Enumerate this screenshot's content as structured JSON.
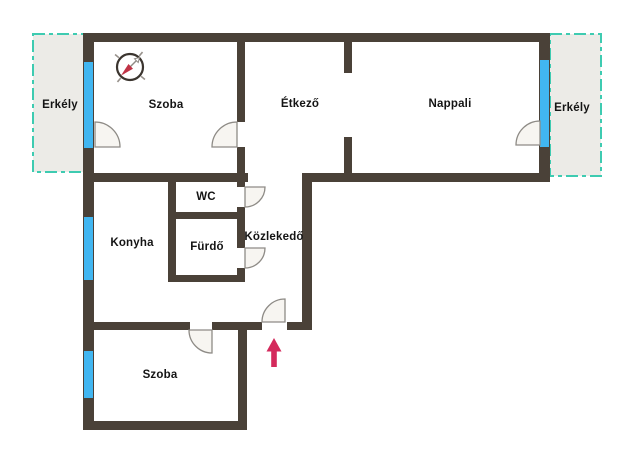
{
  "plan": {
    "type": "apartment-floor-plan",
    "language": "Hungarian",
    "rooms": [
      {
        "id": "erkely-left",
        "label": "Erkély"
      },
      {
        "id": "szoba-top",
        "label": "Szoba"
      },
      {
        "id": "etkezo",
        "label": "Étkező"
      },
      {
        "id": "nappali",
        "label": "Nappali"
      },
      {
        "id": "erkely-right",
        "label": "Erkély"
      },
      {
        "id": "konyha",
        "label": "Konyha"
      },
      {
        "id": "wc",
        "label": "WC"
      },
      {
        "id": "furdo",
        "label": "Fürdő"
      },
      {
        "id": "kozlekedo",
        "label": "Közlekedő"
      },
      {
        "id": "szoba-bottom",
        "label": "Szoba"
      }
    ],
    "icons": {
      "compass": "compass-rose-icon",
      "entrance": "entrance-arrow-icon"
    }
  },
  "colors": {
    "background": "#ffffff",
    "wall": "#4a4138",
    "window": "#41b6f1",
    "balcony_fill": "#ecebe7",
    "balcony_border": "#3ecbb1",
    "door_fill": "#f7f5f1",
    "door_stroke": "#8e8b86",
    "label": "#141414",
    "arrow": "#d42a5c",
    "compass_ring": "#3b352f",
    "compass_tick": "#97918b",
    "compass_needle_red": "#c03346",
    "compass_needle_gray": "#8f8a84"
  }
}
